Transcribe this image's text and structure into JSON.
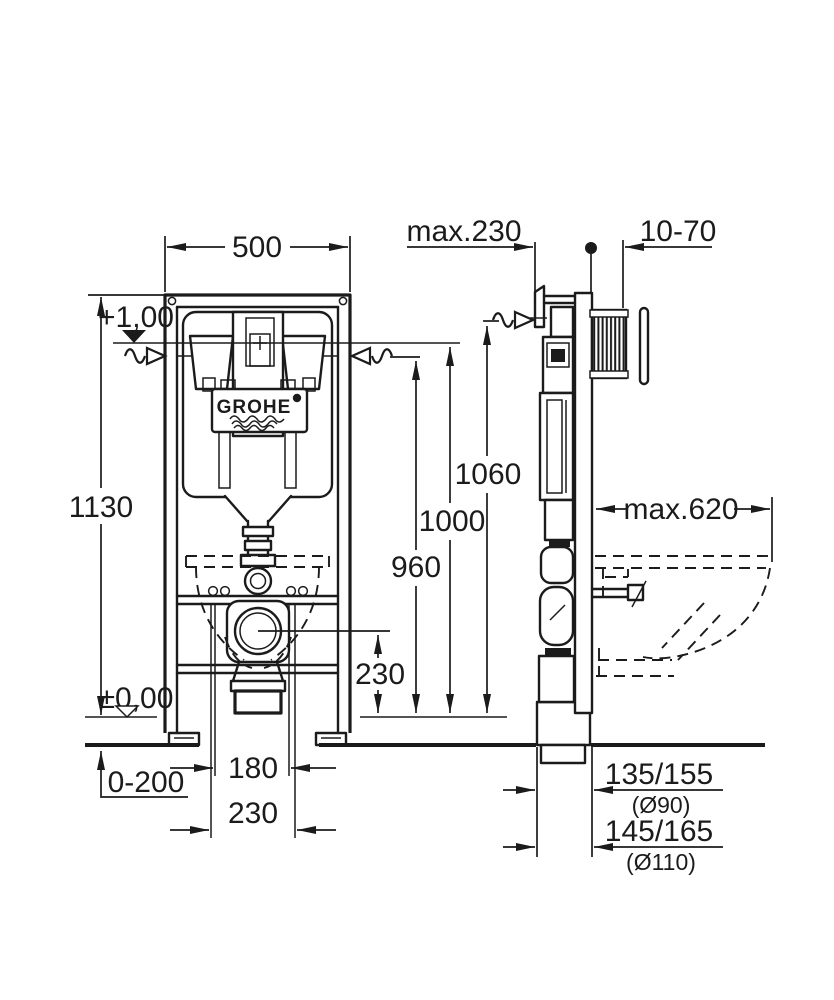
{
  "drawing": {
    "type": "installation-dimensional-drawing",
    "brand": "GROHE",
    "front_view": {
      "frame_width": "500",
      "overall_height": "1130",
      "level_top": "+1,00",
      "level_floor": "±0,00",
      "floor_buildup": "0-200",
      "spacing_inner": "180",
      "spacing_outer": "230"
    },
    "elevations": {
      "h_top": "1060",
      "h_mid": "1000",
      "h_low": "960",
      "outlet_height": "230"
    },
    "side_view": {
      "frame_depth": "max.230",
      "wall_finish_range": "10-70",
      "bowl_depth": "max.620",
      "drain_offset_1": "135/155",
      "drain_offset_1_dia": "(Ø90)",
      "drain_offset_2": "145/165",
      "drain_offset_2_dia": "(Ø110)"
    },
    "logo": {
      "text": "GROHE"
    }
  }
}
